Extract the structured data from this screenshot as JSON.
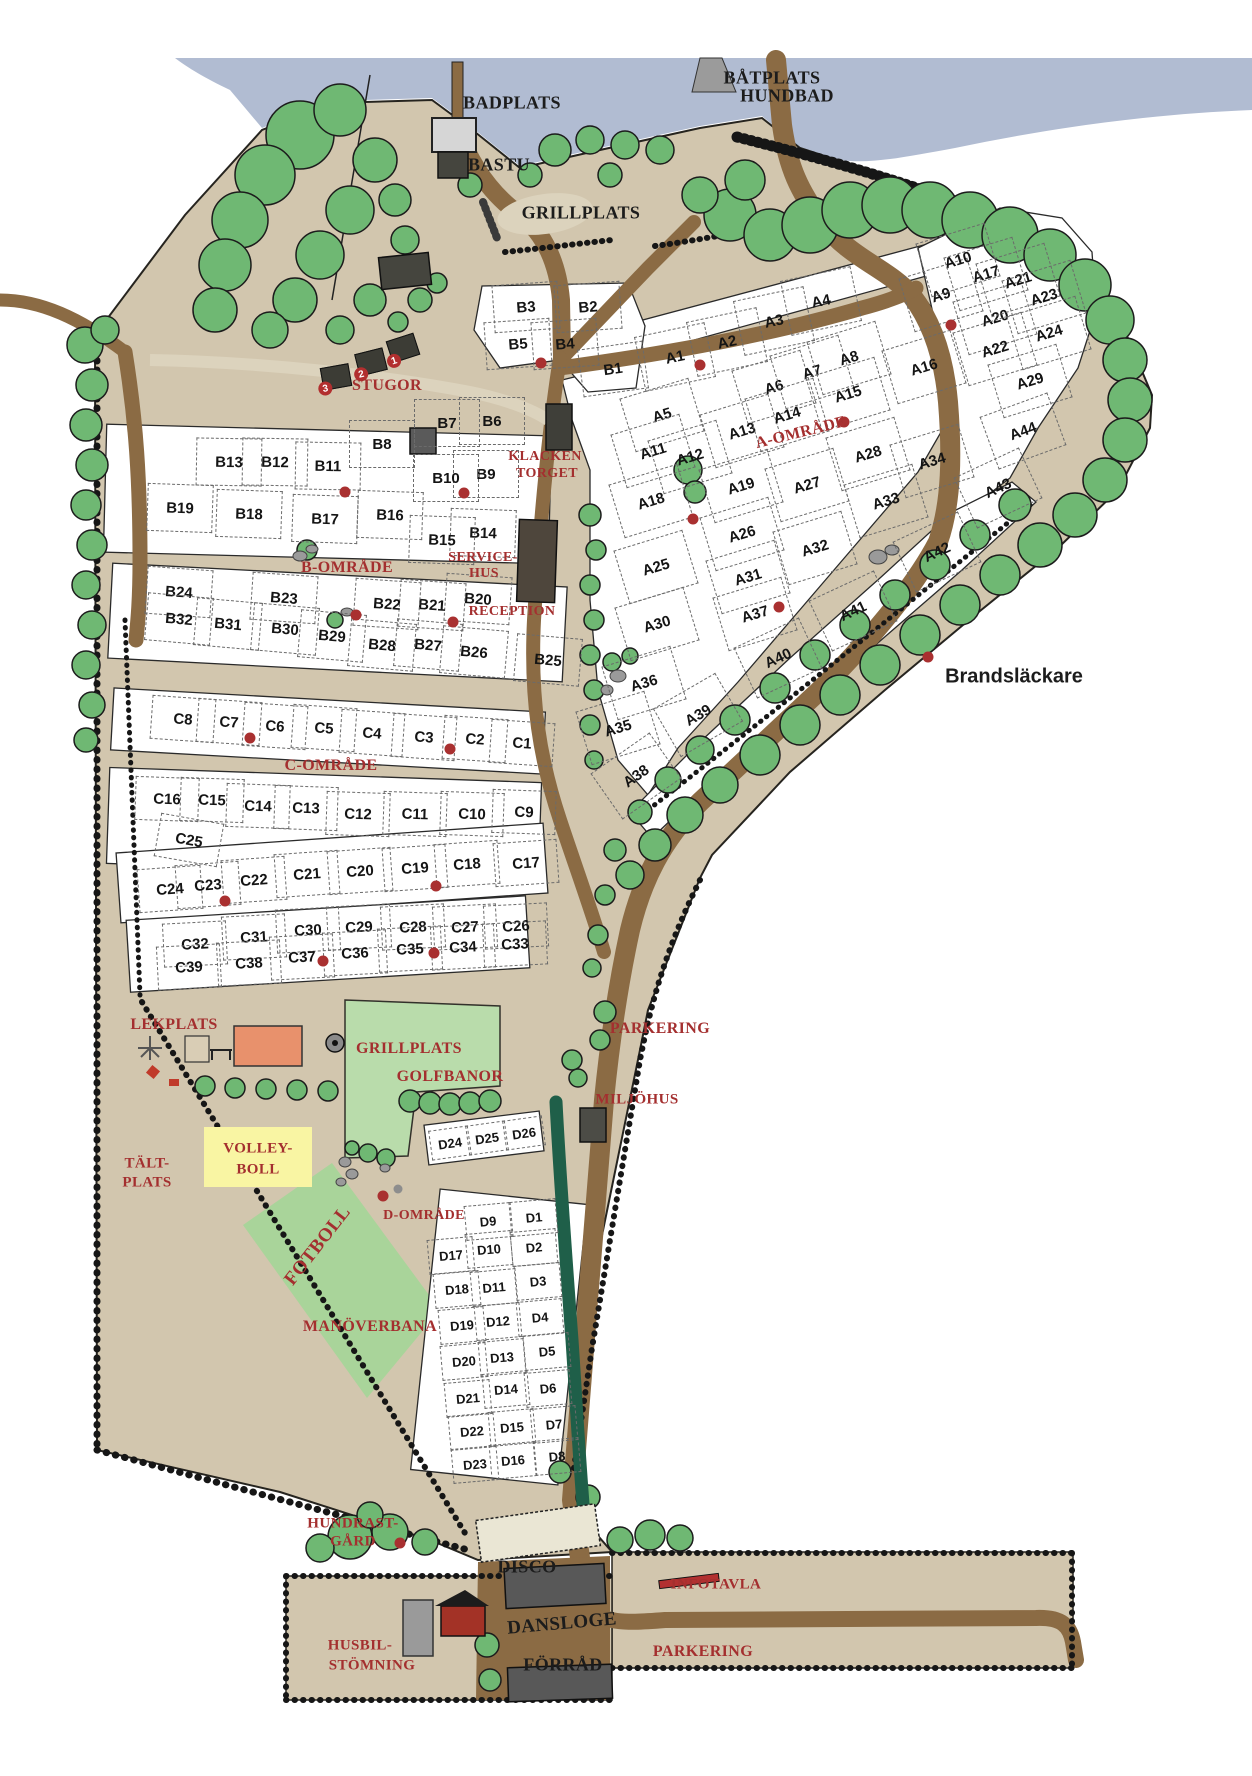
{
  "colors": {
    "water": "#b1bcd2",
    "land": "#d2c6ae",
    "road": "#8b6b44",
    "path_light": "#dcd3bd",
    "tree": "#6fb873",
    "hedge": "#1f5f49",
    "field_light": "#b9dcab",
    "field_dark": "#a9d49a",
    "plot_white": "#ffffff",
    "label_red": "#a42f2f",
    "text_black": "#1c1c1c",
    "dot_red": "#a93030",
    "lekplats_orange": "#e8916c",
    "volleyball_yellow": "#f9f5a3"
  },
  "facilities": [
    {
      "text": "BADPLATS",
      "x": 512,
      "y": 103,
      "size": 18,
      "color": "black"
    },
    {
      "text": "BÅTPLATS",
      "x": 772,
      "y": 78,
      "size": 18,
      "color": "black"
    },
    {
      "text": "HUNDBAD",
      "x": 787,
      "y": 96,
      "size": 18,
      "color": "black"
    },
    {
      "text": "BASTU",
      "x": 499,
      "y": 165,
      "size": 18,
      "color": "black"
    },
    {
      "text": "GRILLPLATS",
      "x": 581,
      "y": 213,
      "size": 18,
      "color": "black"
    },
    {
      "text": "STUGOR",
      "x": 387,
      "y": 386,
      "size": 16,
      "color": "red"
    },
    {
      "text": "KLACKEN",
      "x": 545,
      "y": 457,
      "size": 14,
      "color": "red"
    },
    {
      "text": "TORGET",
      "x": 547,
      "y": 474,
      "size": 14,
      "color": "red"
    },
    {
      "text": "SERVICE-",
      "x": 483,
      "y": 558,
      "size": 14,
      "color": "red"
    },
    {
      "text": "HUS",
      "x": 484,
      "y": 574,
      "size": 14,
      "color": "red"
    },
    {
      "text": "RECEPTION",
      "x": 512,
      "y": 612,
      "size": 14,
      "color": "red"
    },
    {
      "text": "B-OMRÅDE",
      "x": 347,
      "y": 568,
      "size": 16,
      "color": "red"
    },
    {
      "text": "A-OMRÅDE",
      "x": 801,
      "y": 433,
      "size": 16,
      "color": "red",
      "rot": -14
    },
    {
      "text": "C-OMRÅDE",
      "x": 331,
      "y": 766,
      "size": 16,
      "color": "red"
    },
    {
      "text": "Brandsläckare",
      "x": 1014,
      "y": 677,
      "size": 20,
      "color": "black",
      "sans": true
    },
    {
      "text": "LEKPLATS",
      "x": 174,
      "y": 1025,
      "size": 16,
      "color": "red"
    },
    {
      "text": "GRILLPLATS",
      "x": 409,
      "y": 1049,
      "size": 16,
      "color": "red"
    },
    {
      "text": "GOLFBANOR",
      "x": 450,
      "y": 1077,
      "size": 16,
      "color": "red"
    },
    {
      "text": "PARKERING",
      "x": 660,
      "y": 1029,
      "size": 16,
      "color": "red"
    },
    {
      "text": "MILJÖHUS",
      "x": 637,
      "y": 1100,
      "size": 15,
      "color": "red"
    },
    {
      "text": "VOLLEY-",
      "x": 258,
      "y": 1149,
      "size": 15,
      "color": "red"
    },
    {
      "text": "BOLL",
      "x": 258,
      "y": 1170,
      "size": 15,
      "color": "red"
    },
    {
      "text": "TÄLT-",
      "x": 147,
      "y": 1164,
      "size": 15,
      "color": "red"
    },
    {
      "text": "PLATS",
      "x": 147,
      "y": 1183,
      "size": 15,
      "color": "red"
    },
    {
      "text": "D-OMRÅDE",
      "x": 424,
      "y": 1216,
      "size": 14,
      "color": "red"
    },
    {
      "text": "FOTBOLL",
      "x": 318,
      "y": 1246,
      "size": 19,
      "color": "red",
      "rot": -52
    },
    {
      "text": "MANÖVERBANA",
      "x": 370,
      "y": 1327,
      "size": 16,
      "color": "red"
    },
    {
      "text": "HUNDRAST-",
      "x": 353,
      "y": 1524,
      "size": 15,
      "color": "red"
    },
    {
      "text": "GÅRD",
      "x": 353,
      "y": 1542,
      "size": 15,
      "color": "red"
    },
    {
      "text": "DISCO",
      "x": 527,
      "y": 1567,
      "size": 18,
      "color": "black"
    },
    {
      "text": "DANSLOGE",
      "x": 562,
      "y": 1624,
      "size": 19,
      "color": "black",
      "rot": -5
    },
    {
      "text": "INFOTAVLA",
      "x": 716,
      "y": 1585,
      "size": 15,
      "color": "red"
    },
    {
      "text": "HUSBIL-",
      "x": 360,
      "y": 1646,
      "size": 15,
      "color": "red"
    },
    {
      "text": "STÖMNING",
      "x": 372,
      "y": 1666,
      "size": 15,
      "color": "red"
    },
    {
      "text": "FÖRRÅD",
      "x": 563,
      "y": 1665,
      "size": 18,
      "color": "black"
    },
    {
      "text": "PARKERING",
      "x": 703,
      "y": 1652,
      "size": 16,
      "color": "red"
    }
  ],
  "areas": {
    "A": {
      "cell_w": 70,
      "cell_h": 54,
      "rot": -17,
      "font": 15,
      "plots": [
        {
          "id": "A1",
          "x": 674,
          "y": 356,
          "rot": -12
        },
        {
          "id": "A2",
          "x": 726,
          "y": 341,
          "rot": -12
        },
        {
          "id": "A3",
          "x": 773,
          "y": 320,
          "rot": -12
        },
        {
          "id": "A4",
          "x": 820,
          "y": 300,
          "rot": -12
        },
        {
          "id": "A5",
          "x": 661,
          "y": 414
        },
        {
          "id": "A6",
          "x": 773,
          "y": 386
        },
        {
          "id": "A7",
          "x": 811,
          "y": 371
        },
        {
          "id": "A8",
          "x": 848,
          "y": 357
        },
        {
          "id": "A9",
          "x": 940,
          "y": 294
        },
        {
          "id": "A10",
          "x": 957,
          "y": 259
        },
        {
          "id": "A11",
          "x": 652,
          "y": 450
        },
        {
          "id": "A12",
          "x": 689,
          "y": 456
        },
        {
          "id": "A13",
          "x": 741,
          "y": 430
        },
        {
          "id": "A14",
          "x": 786,
          "y": 414
        },
        {
          "id": "A15",
          "x": 847,
          "y": 393
        },
        {
          "id": "A16",
          "x": 923,
          "y": 366
        },
        {
          "id": "A17",
          "x": 985,
          "y": 273
        },
        {
          "id": "A18",
          "x": 650,
          "y": 500
        },
        {
          "id": "A19",
          "x": 740,
          "y": 485
        },
        {
          "id": "A20",
          "x": 994,
          "y": 317
        },
        {
          "id": "A21",
          "x": 1017,
          "y": 279
        },
        {
          "id": "A22",
          "x": 994,
          "y": 348
        },
        {
          "id": "A23",
          "x": 1043,
          "y": 296
        },
        {
          "id": "A24",
          "x": 1048,
          "y": 332
        },
        {
          "id": "A25",
          "x": 655,
          "y": 566
        },
        {
          "id": "A26",
          "x": 741,
          "y": 533
        },
        {
          "id": "A27",
          "x": 806,
          "y": 484
        },
        {
          "id": "A28",
          "x": 867,
          "y": 453
        },
        {
          "id": "A29",
          "x": 1029,
          "y": 380
        },
        {
          "id": "A30",
          "x": 656,
          "y": 623
        },
        {
          "id": "A31",
          "x": 747,
          "y": 576
        },
        {
          "id": "A32",
          "x": 814,
          "y": 547
        },
        {
          "id": "A33",
          "x": 885,
          "y": 500
        },
        {
          "id": "A34",
          "x": 931,
          "y": 460
        },
        {
          "id": "A35",
          "x": 617,
          "y": 727
        },
        {
          "id": "A36",
          "x": 643,
          "y": 682
        },
        {
          "id": "A37",
          "x": 754,
          "y": 613
        },
        {
          "id": "A38",
          "x": 635,
          "y": 775,
          "rot": -35
        },
        {
          "id": "A39",
          "x": 697,
          "y": 714,
          "rot": -30
        },
        {
          "id": "A40",
          "x": 777,
          "y": 657,
          "rot": -25
        },
        {
          "id": "A41",
          "x": 852,
          "y": 610,
          "rot": -25
        },
        {
          "id": "A42",
          "x": 936,
          "y": 551,
          "rot": -25
        },
        {
          "id": "A43",
          "x": 997,
          "y": 487,
          "rot": -25
        },
        {
          "id": "A44",
          "x": 1022,
          "y": 430,
          "rot": -20
        }
      ]
    },
    "B": {
      "cell_w": 64,
      "cell_h": 46,
      "rot": 2,
      "font": 15,
      "plots": [
        {
          "id": "B1",
          "x": 612,
          "y": 368,
          "rot": -8
        },
        {
          "id": "B2",
          "x": 587,
          "y": 306,
          "rot": -4
        },
        {
          "id": "B3",
          "x": 525,
          "y": 306,
          "rot": -4
        },
        {
          "id": "B4",
          "x": 564,
          "y": 343,
          "rot": -4
        },
        {
          "id": "B5",
          "x": 517,
          "y": 343,
          "rot": -4
        },
        {
          "id": "B6",
          "x": 491,
          "y": 420,
          "rot": 0
        },
        {
          "id": "B7",
          "x": 446,
          "y": 422,
          "rot": 0
        },
        {
          "id": "B8",
          "x": 381,
          "y": 443,
          "rot": 0
        },
        {
          "id": "B9",
          "x": 485,
          "y": 473,
          "rot": 0
        },
        {
          "id": "B10",
          "x": 445,
          "y": 477,
          "rot": 0
        },
        {
          "id": "B11",
          "x": 327,
          "y": 465,
          "rot": 1
        },
        {
          "id": "B12",
          "x": 274,
          "y": 461,
          "rot": 1
        },
        {
          "id": "B13",
          "x": 228,
          "y": 461,
          "rot": 1
        },
        {
          "id": "B14",
          "x": 482,
          "y": 532
        },
        {
          "id": "B15",
          "x": 441,
          "y": 539
        },
        {
          "id": "B16",
          "x": 389,
          "y": 514
        },
        {
          "id": "B17",
          "x": 324,
          "y": 518
        },
        {
          "id": "B18",
          "x": 248,
          "y": 513
        },
        {
          "id": "B19",
          "x": 179,
          "y": 507
        },
        {
          "id": "B20",
          "x": 477,
          "y": 598,
          "rot": 4
        },
        {
          "id": "B21",
          "x": 431,
          "y": 604,
          "rot": 4
        },
        {
          "id": "B22",
          "x": 386,
          "y": 603,
          "rot": 4
        },
        {
          "id": "B23",
          "x": 283,
          "y": 597,
          "rot": 4
        },
        {
          "id": "B24",
          "x": 178,
          "y": 591,
          "rot": 4
        },
        {
          "id": "B25",
          "x": 547,
          "y": 659,
          "rot": 5
        },
        {
          "id": "B26",
          "x": 473,
          "y": 651,
          "rot": 5
        },
        {
          "id": "B27",
          "x": 427,
          "y": 644,
          "rot": 5
        },
        {
          "id": "B28",
          "x": 381,
          "y": 644,
          "rot": 5
        },
        {
          "id": "B29",
          "x": 331,
          "y": 635,
          "rot": 5
        },
        {
          "id": "B30",
          "x": 284,
          "y": 628,
          "rot": 5
        },
        {
          "id": "B31",
          "x": 227,
          "y": 623,
          "rot": 5
        },
        {
          "id": "B32",
          "x": 178,
          "y": 618,
          "rot": 5
        }
      ]
    },
    "C": {
      "cell_w": 62,
      "cell_h": 42,
      "rot": 4,
      "font": 15,
      "plots": [
        {
          "id": "C1",
          "x": 521,
          "y": 742
        },
        {
          "id": "C2",
          "x": 474,
          "y": 738
        },
        {
          "id": "C3",
          "x": 423,
          "y": 736
        },
        {
          "id": "C4",
          "x": 371,
          "y": 732
        },
        {
          "id": "C5",
          "x": 323,
          "y": 727
        },
        {
          "id": "C6",
          "x": 274,
          "y": 725
        },
        {
          "id": "C7",
          "x": 228,
          "y": 721
        },
        {
          "id": "C8",
          "x": 182,
          "y": 718
        },
        {
          "id": "C9",
          "x": 523,
          "y": 811,
          "rot": 2
        },
        {
          "id": "C10",
          "x": 471,
          "y": 813,
          "rot": 2
        },
        {
          "id": "C11",
          "x": 414,
          "y": 813,
          "rot": 2
        },
        {
          "id": "C12",
          "x": 357,
          "y": 813,
          "rot": 2
        },
        {
          "id": "C13",
          "x": 305,
          "y": 807,
          "rot": 2
        },
        {
          "id": "C14",
          "x": 257,
          "y": 805,
          "rot": 2
        },
        {
          "id": "C15",
          "x": 211,
          "y": 799,
          "rot": 2
        },
        {
          "id": "C16",
          "x": 166,
          "y": 798,
          "rot": 2
        },
        {
          "id": "C17",
          "x": 525,
          "y": 862,
          "rot": -4
        },
        {
          "id": "C18",
          "x": 466,
          "y": 863,
          "rot": -4
        },
        {
          "id": "C19",
          "x": 414,
          "y": 867,
          "rot": -4
        },
        {
          "id": "C20",
          "x": 359,
          "y": 870,
          "rot": -4
        },
        {
          "id": "C21",
          "x": 306,
          "y": 873,
          "rot": -4
        },
        {
          "id": "C22",
          "x": 253,
          "y": 879,
          "rot": -4
        },
        {
          "id": "C23",
          "x": 207,
          "y": 884,
          "rot": -4
        },
        {
          "id": "C24",
          "x": 169,
          "y": 888,
          "rot": -4
        },
        {
          "id": "C25",
          "x": 188,
          "y": 839,
          "rot": 10
        },
        {
          "id": "C26",
          "x": 515,
          "y": 925,
          "rot": -3
        },
        {
          "id": "C27",
          "x": 464,
          "y": 926,
          "rot": -3
        },
        {
          "id": "C28",
          "x": 412,
          "y": 926,
          "rot": -3
        },
        {
          "id": "C29",
          "x": 358,
          "y": 926,
          "rot": -3
        },
        {
          "id": "C30",
          "x": 307,
          "y": 929,
          "rot": -3
        },
        {
          "id": "C31",
          "x": 253,
          "y": 936,
          "rot": -3
        },
        {
          "id": "C32",
          "x": 194,
          "y": 943,
          "rot": -3
        },
        {
          "id": "C33",
          "x": 514,
          "y": 943,
          "rot": -3
        },
        {
          "id": "C34",
          "x": 462,
          "y": 946,
          "rot": -3
        },
        {
          "id": "C35",
          "x": 409,
          "y": 948,
          "rot": -3
        },
        {
          "id": "C36",
          "x": 354,
          "y": 952,
          "rot": -3
        },
        {
          "id": "C37",
          "x": 301,
          "y": 956,
          "rot": -3
        },
        {
          "id": "C38",
          "x": 248,
          "y": 962,
          "rot": -3
        },
        {
          "id": "C39",
          "x": 188,
          "y": 966,
          "rot": -3
        }
      ]
    },
    "D": {
      "cell_w": 44,
      "cell_h": 33,
      "rot": -5,
      "font": 13,
      "plots": [
        {
          "id": "D1",
          "x": 533,
          "y": 1216
        },
        {
          "id": "D2",
          "x": 533,
          "y": 1246
        },
        {
          "id": "D3",
          "x": 537,
          "y": 1280
        },
        {
          "id": "D4",
          "x": 539,
          "y": 1316
        },
        {
          "id": "D5",
          "x": 546,
          "y": 1350
        },
        {
          "id": "D6",
          "x": 547,
          "y": 1387
        },
        {
          "id": "D7",
          "x": 553,
          "y": 1423
        },
        {
          "id": "D8",
          "x": 556,
          "y": 1455
        },
        {
          "id": "D9",
          "x": 487,
          "y": 1220
        },
        {
          "id": "D10",
          "x": 488,
          "y": 1248
        },
        {
          "id": "D11",
          "x": 493,
          "y": 1286
        },
        {
          "id": "D12",
          "x": 497,
          "y": 1320
        },
        {
          "id": "D13",
          "x": 501,
          "y": 1356
        },
        {
          "id": "D14",
          "x": 505,
          "y": 1388
        },
        {
          "id": "D15",
          "x": 511,
          "y": 1426
        },
        {
          "id": "D16",
          "x": 512,
          "y": 1459
        },
        {
          "id": "D17",
          "x": 450,
          "y": 1254
        },
        {
          "id": "D18",
          "x": 456,
          "y": 1288
        },
        {
          "id": "D19",
          "x": 461,
          "y": 1324
        },
        {
          "id": "D20",
          "x": 463,
          "y": 1360
        },
        {
          "id": "D21",
          "x": 467,
          "y": 1397
        },
        {
          "id": "D22",
          "x": 471,
          "y": 1430
        },
        {
          "id": "D23",
          "x": 474,
          "y": 1463
        },
        {
          "id": "D24",
          "x": 449,
          "y": 1142,
          "rot": -8,
          "w": 38,
          "h": 28
        },
        {
          "id": "D25",
          "x": 486,
          "y": 1137,
          "rot": -8,
          "w": 38,
          "h": 28
        },
        {
          "id": "D26",
          "x": 523,
          "y": 1132,
          "rot": -8,
          "w": 38,
          "h": 28
        }
      ]
    }
  },
  "cabins": [
    {
      "n": "1",
      "x": 403,
      "y": 348,
      "rot": -18
    },
    {
      "n": "2",
      "x": 371,
      "y": 362,
      "rot": -14
    },
    {
      "n": "3",
      "x": 336,
      "y": 377,
      "rot": -10
    }
  ],
  "dots": {
    "red": [
      [
        541,
        363
      ],
      [
        700,
        365
      ],
      [
        951,
        325
      ],
      [
        844,
        422
      ],
      [
        693,
        519
      ],
      [
        779,
        607
      ],
      [
        928,
        657
      ],
      [
        345,
        492
      ],
      [
        464,
        493
      ],
      [
        356,
        615
      ],
      [
        453,
        622
      ],
      [
        250,
        738
      ],
      [
        450,
        749
      ],
      [
        225,
        901
      ],
      [
        436,
        886
      ],
      [
        323,
        961
      ],
      [
        434,
        953
      ],
      [
        383,
        1196
      ],
      [
        400,
        1543
      ]
    ],
    "gray": [
      [
        398,
        1189
      ]
    ]
  }
}
